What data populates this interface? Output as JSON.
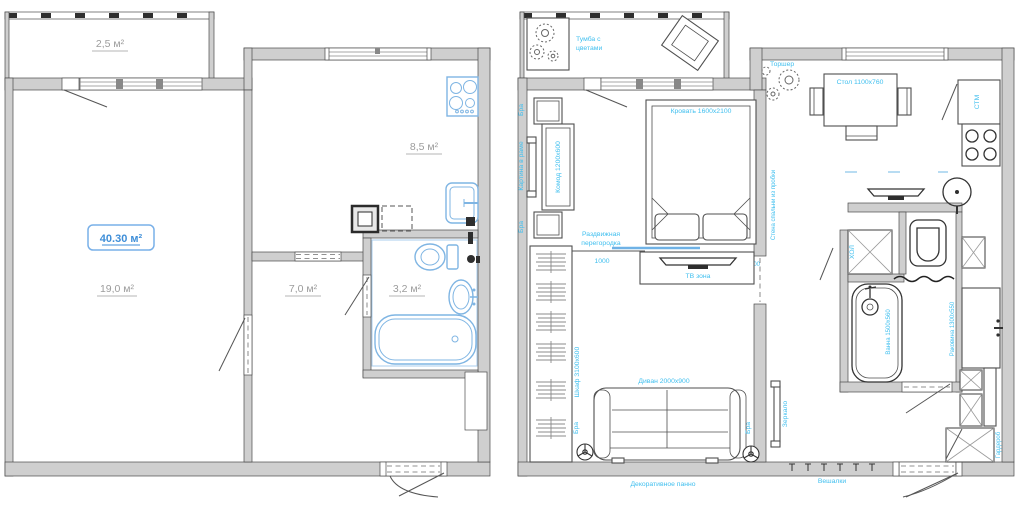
{
  "left_plan": {
    "balcony_area": "2,5 м²",
    "kitchen_area": "8,5 м²",
    "living_area": "19,0 м²",
    "hall_area": "7,0 м²",
    "bath_area": "3,2 м²",
    "total_area": "40.30 м²"
  },
  "right_plan": {
    "balcony": {
      "tumba_line1": "Тумба с",
      "tumba_line2": "цветами"
    },
    "bedroom": {
      "bra": "Бра",
      "picture": "Картина в раме",
      "komod": "Комод 1200x600",
      "bed": "Кровать 1600x2100",
      "partition_line1": "Раздвижная",
      "partition_line2": "перегородка",
      "partition_width": "1000",
      "opening_width": "700",
      "tv_zone": "ТВ зона",
      "wardrobe": "Шкаф 3100x600",
      "sofa": "Диван 2000x900",
      "panno": "Декоративное панно",
      "cork_wall": "Стена спальни из пробки"
    },
    "kitchen": {
      "torsher": "Торшер",
      "table": "Стол 1100x760",
      "stm": "СТМ",
      "fridge": "ХОЛ",
      "counter": "Раковина 1300x550"
    },
    "bathroom": {
      "bath": "Ванна 1500x560"
    },
    "hallway": {
      "mirror": "Зеркало",
      "hooks": "Вешалки",
      "wardrobe": "Гардероб"
    }
  },
  "colors": {
    "label_blue": "#3fbfef",
    "area_gray": "#9c9c9c",
    "fixture_blue": "#7fb5e3",
    "total_badge_blue": "#3e8ed8",
    "wall_gray": "#cfcfcf"
  }
}
